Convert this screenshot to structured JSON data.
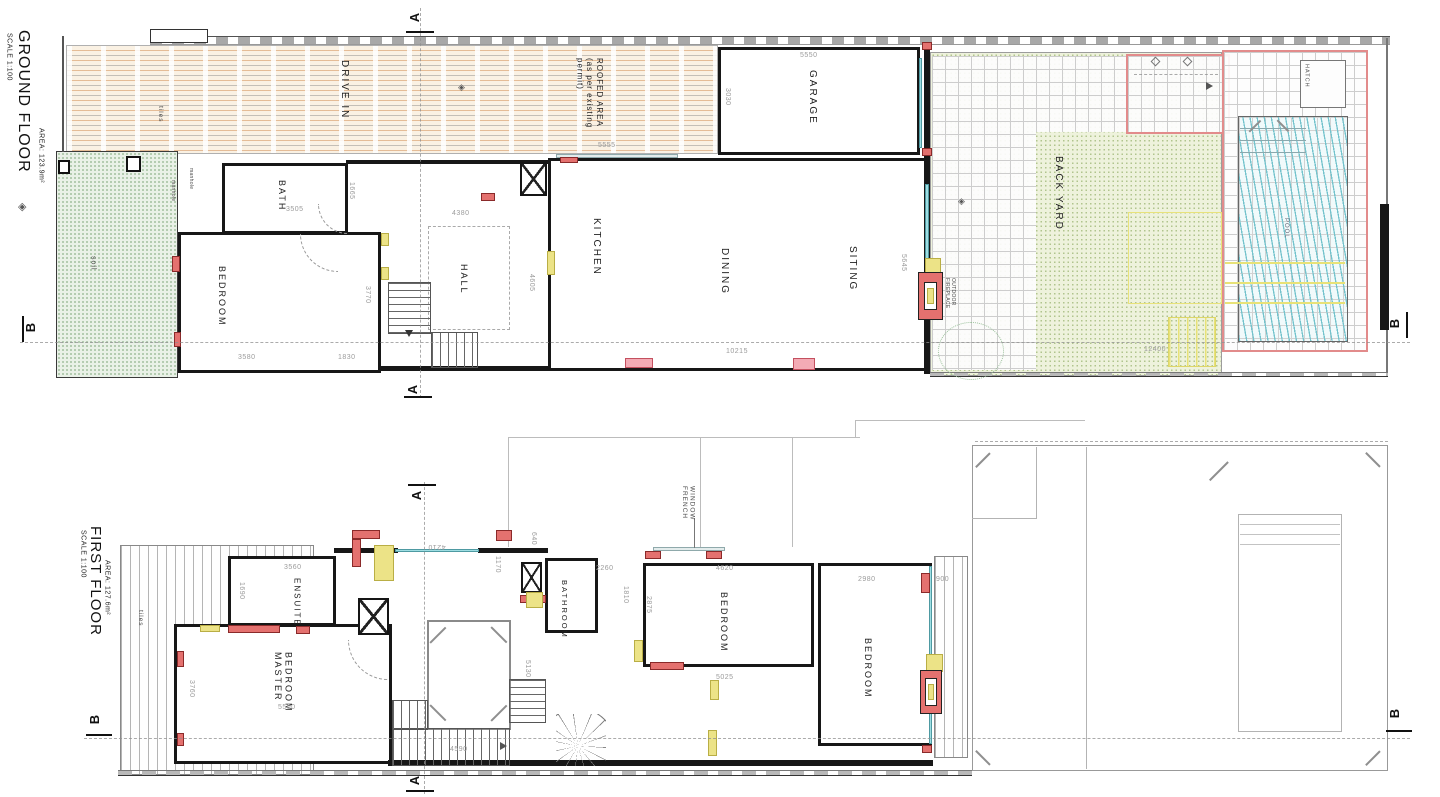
{
  "ground_floor": {
    "title": "GROUND FLOOR",
    "scale": "SCALE 1:100",
    "area": "AREA: 123.9m²",
    "labels": {
      "drive_in": "DRIVE IN",
      "tiles": "tiles",
      "roofed_area": "ROOFED AREA\n(as per existing\npermit)",
      "garage": "GARAGE",
      "bath": "BATH",
      "bedroom": "BEDROOM",
      "hall": "HALL",
      "kitchen": "KITCHEN",
      "dining": "DINING",
      "sitting": "SITING",
      "back_yard": "BACK YARD",
      "pool": "POOL",
      "hatch": "HATCH",
      "soil": "soil",
      "manhole": "manhole",
      "outdoor_fireplace": "OUTDOOR\nFIREPLACE"
    },
    "dims": {
      "garage_width": "5550",
      "garage_depth": "3030",
      "roofed_width": "5555",
      "hall_width": "4380",
      "hall_depth": "4605",
      "bath_width": "3505",
      "bath_depth": "1665",
      "bedroom_width": "3580",
      "bedroom_pass": "1830",
      "bedroom_depth": "3770",
      "living_width": "10215",
      "living_depth": "5645",
      "yard_width": "12400"
    }
  },
  "first_floor": {
    "title": "FIRST FLOOR",
    "scale": "SCALE 1:100",
    "area": "AREA: 127.6m²",
    "labels": {
      "tiles": "tiles",
      "ensuite": "ENSUITE",
      "master_bedroom": "MASTER\nBEDROOM",
      "bathroom": "BATHROOM",
      "bedroom": "BEDROOM",
      "french_window": "FRENCH\nWINDOW"
    },
    "dims": {
      "ensuite_width": "3560",
      "ensuite_depth": "1690",
      "master_width": "5500",
      "master_depth": "3760",
      "landing_width": "4210",
      "landing_depth": "1170",
      "window": "640",
      "bathroom_width": "2260",
      "bathroom_depth": "1810",
      "bedroom2_width": "4620",
      "bedroom2_depth": "2875",
      "bedroom2_span": "5025",
      "bedroom3_width": "2980",
      "balcony_depth": "900",
      "stair_run": "4590",
      "stair_depth": "5130"
    }
  },
  "markers": {
    "a": "A",
    "b": "B"
  }
}
